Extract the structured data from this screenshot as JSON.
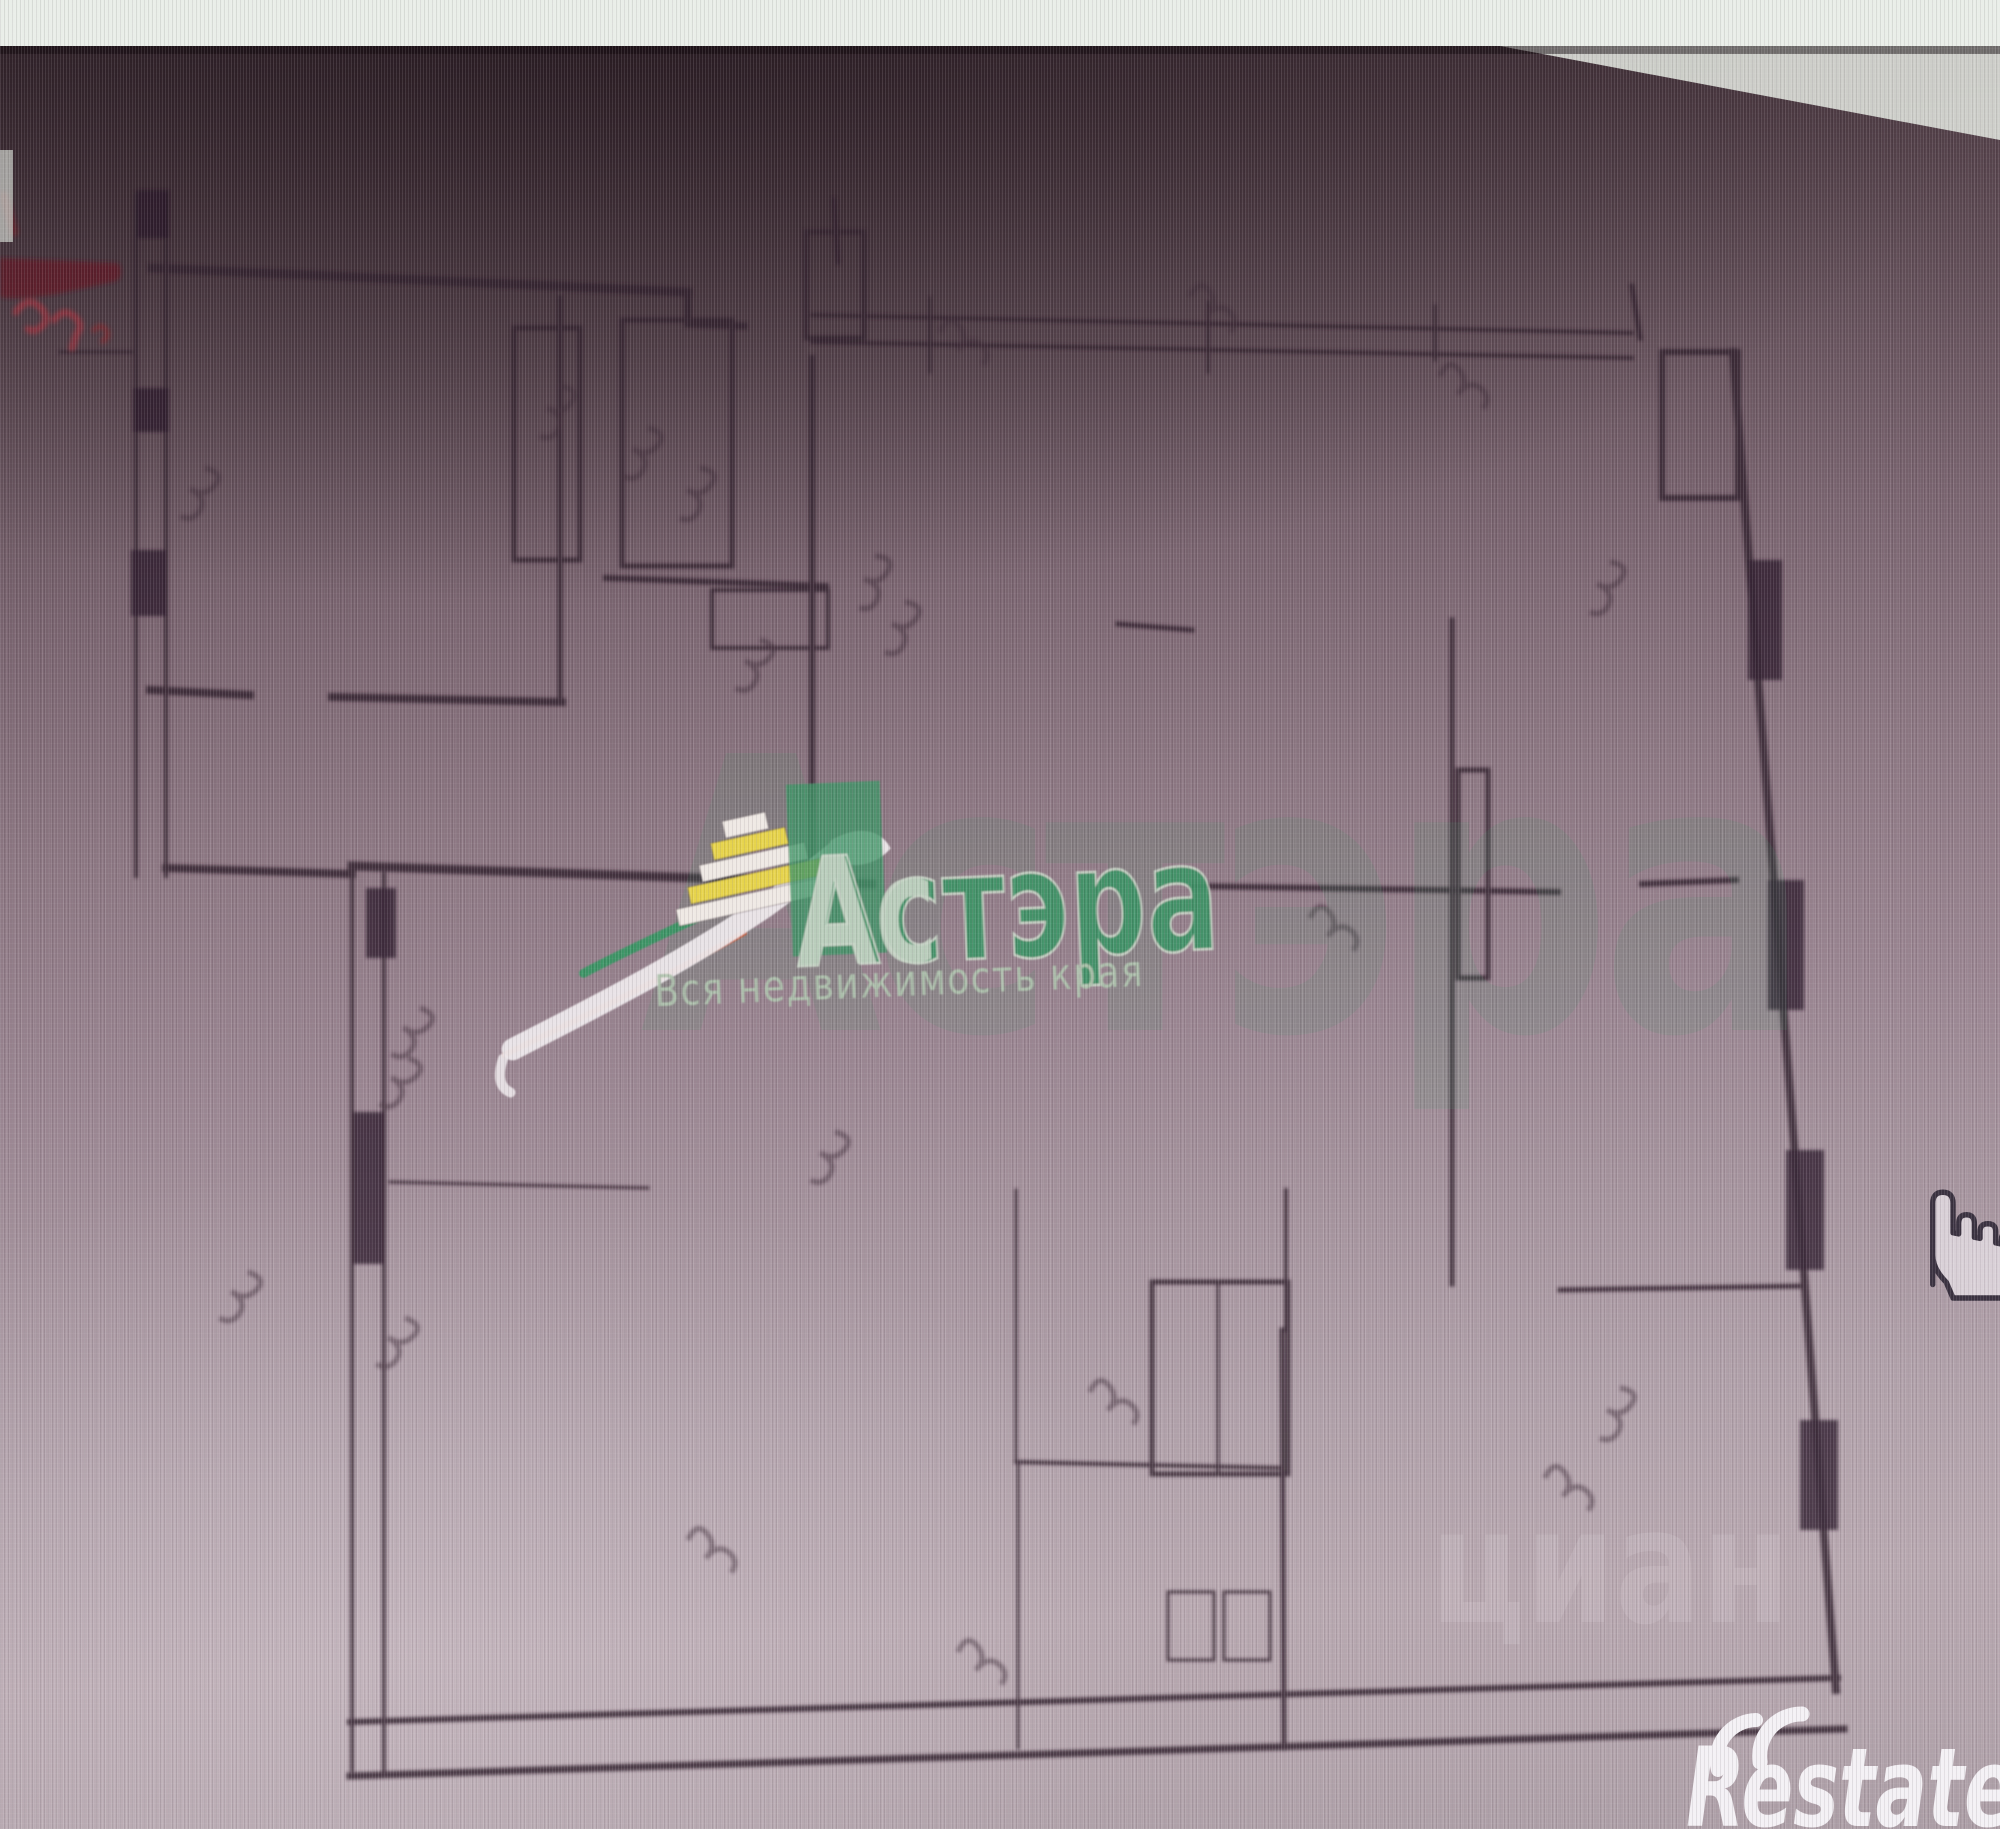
{
  "photo": {
    "strip_color": "#e9eee8",
    "wedge_color": "#dcdfd8",
    "bg_top": "#392a31",
    "bg_bottom": "#b3a4ac"
  },
  "stamp": {
    "color": "#8c2630",
    "paths": [
      {
        "d": "M0 258 L118 263 Q125 272 117 281 L62 293 Q18 301 0 297 Z",
        "fill": "#5f1d26",
        "opacity": 0.8
      },
      {
        "d": "M16 312 q12 -17 25 -4 q10 11 0 19 q-7 6 -13 2",
        "stroke": "#97303c",
        "sw": 7,
        "opacity": 0.75
      },
      {
        "d": "M54 320 q10 -13 21 -3 q9 9 2 16 l-5 15",
        "stroke": "#97303c",
        "sw": 7,
        "opacity": 0.75
      },
      {
        "d": "M94 330 q7 -7 12 0 q4 6 -3 11",
        "stroke": "#7d2630",
        "sw": 6,
        "opacity": 0.7
      },
      {
        "d": "M4 196 l10 36",
        "stroke": "#6d2029",
        "sw": 9,
        "opacity": 0.6
      }
    ]
  },
  "watermarks": {
    "astera": {
      "brand": "Астэра",
      "brand_prefix": "Ас",
      "tagline": "Вся недвижимость края",
      "green": "#3e9365",
      "light": "#c6d4c5",
      "tagline_color": "#adc2ac"
    },
    "big_faint": {
      "text": "Астэра",
      "color": "#3e9365",
      "opacity": 0.13
    },
    "cian": {
      "text": "циан",
      "color": "#ffffff",
      "opacity": 0.11
    },
    "restate": {
      "text": "Restate",
      "color": "#f4f1f5"
    }
  },
  "cursor": {
    "type": "hand-pointer",
    "outline": "#3a3240",
    "fill": "#d9d0d7"
  },
  "plan": {
    "wall_color": "#33202d",
    "pier_color": "#271827",
    "mark_color": "#3a2a36",
    "mark_path": "M0 0 q5 -11 11 -3 q5 7 -1 13 q7 -9 14 -2 q4 5 0 10",
    "walls": [
      [
        136,
        194,
        136,
        876,
        4
      ],
      [
        166,
        194,
        166,
        876,
        4
      ],
      [
        152,
        268,
        688,
        292,
        9
      ],
      [
        688,
        292,
        688,
        324,
        7
      ],
      [
        688,
        324,
        744,
        326,
        7
      ],
      [
        150,
        690,
        250,
        695,
        8
      ],
      [
        332,
        697,
        562,
        702,
        8
      ],
      [
        560,
        298,
        560,
        700,
        5
      ],
      [
        60,
        352,
        132,
        352,
        3
      ],
      [
        166,
        868,
        352,
        874,
        8
      ],
      [
        352,
        874,
        352,
        1770,
        4
      ],
      [
        384,
        874,
        384,
        1770,
        4
      ],
      [
        352,
        866,
        872,
        884,
        9
      ],
      [
        350,
        1722,
        1838,
        1678,
        6
      ],
      [
        350,
        1776,
        1844,
        1729,
        7
      ],
      [
        1733,
        352,
        1836,
        1690,
        8
      ],
      [
        812,
        315,
        1632,
        333,
        4
      ],
      [
        812,
        342,
        1632,
        358,
        4
      ],
      [
        930,
        298,
        930,
        372,
        3
      ],
      [
        1208,
        302,
        1208,
        372,
        3
      ],
      [
        1435,
        306,
        1435,
        360,
        3
      ],
      [
        1632,
        286,
        1640,
        338,
        5
      ],
      [
        834,
        200,
        838,
        262,
        5
      ],
      [
        812,
        358,
        812,
        868,
        6
      ],
      [
        606,
        578,
        826,
        586,
        6
      ],
      [
        1118,
        624,
        1192,
        630,
        5
      ],
      [
        1452,
        620,
        1452,
        1284,
        5
      ],
      [
        1192,
        886,
        1558,
        892,
        6
      ],
      [
        1642,
        884,
        1736,
        880,
        6
      ],
      [
        1560,
        1290,
        1806,
        1286,
        5
      ],
      [
        1282,
        1330,
        1284,
        1748,
        5
      ],
      [
        1286,
        1190,
        1286,
        1330,
        4
      ],
      [
        1016,
        1462,
        1282,
        1468,
        4
      ],
      [
        1018,
        1462,
        1018,
        1748,
        3
      ],
      [
        1016,
        1190,
        1016,
        1462,
        3
      ],
      [
        1218,
        1285,
        1218,
        1474,
        3
      ],
      [
        390,
        1182,
        648,
        1188,
        3
      ]
    ],
    "piers": [
      [
        137,
        190,
        32,
        48
      ],
      [
        133,
        388,
        36,
        44
      ],
      [
        131,
        550,
        36,
        66
      ],
      [
        366,
        888,
        30,
        70
      ],
      [
        354,
        1112,
        30,
        152
      ],
      [
        1748,
        560,
        34,
        120
      ],
      [
        1768,
        880,
        36,
        130
      ],
      [
        1786,
        1150,
        38,
        120
      ],
      [
        1800,
        1420,
        38,
        110
      ]
    ],
    "boxes": [
      [
        514,
        328,
        66,
        232,
        5
      ],
      [
        622,
        320,
        110,
        246,
        5
      ],
      [
        712,
        590,
        116,
        58,
        4
      ],
      [
        806,
        232,
        58,
        106,
        5
      ],
      [
        1152,
        1282,
        136,
        192,
        5
      ],
      [
        1168,
        1592,
        46,
        68,
        3
      ],
      [
        1224,
        1592,
        46,
        68,
        3
      ],
      [
        1662,
        352,
        76,
        146,
        6
      ],
      [
        1458,
        770,
        30,
        208,
        5
      ]
    ],
    "marks": [
      [
        205,
        468,
        80
      ],
      [
        560,
        386,
        75
      ],
      [
        648,
        428,
        80
      ],
      [
        700,
        468,
        75
      ],
      [
        875,
        556,
        70
      ],
      [
        905,
        602,
        75
      ],
      [
        940,
        332,
        0
      ],
      [
        1190,
        296,
        5
      ],
      [
        1440,
        376,
        0
      ],
      [
        1310,
        918,
        0
      ],
      [
        1610,
        562,
        75
      ],
      [
        835,
        1132,
        80
      ],
      [
        420,
        1008,
        85
      ],
      [
        408,
        1058,
        85
      ],
      [
        248,
        1272,
        85
      ],
      [
        1620,
        1388,
        75
      ],
      [
        1545,
        1478,
        0
      ],
      [
        405,
        1318,
        85
      ],
      [
        760,
        640,
        80
      ],
      [
        1090,
        1392,
        0
      ],
      [
        958,
        1652,
        0
      ],
      [
        688,
        1540,
        0
      ]
    ]
  }
}
